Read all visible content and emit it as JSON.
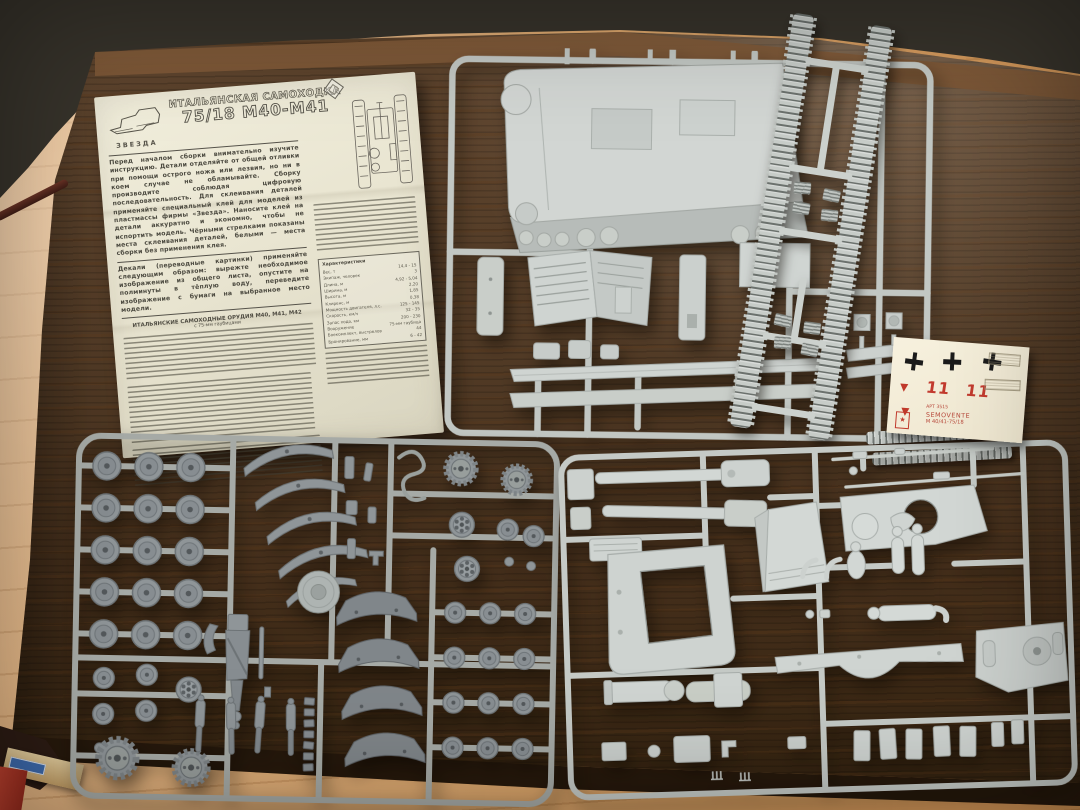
{
  "palette": {
    "table_wood": "#503a27",
    "curtain": "#37332b",
    "floor": "#dca96e",
    "paper": "#ece8d6",
    "sprue_light": "#c7ccc8",
    "sprue_dark": "#90969a",
    "decal_red": "#c0392b",
    "decal_black": "#1b1b1b"
  },
  "instruction_sheet": {
    "brand": "ЗВЕЗДА",
    "title_line1": "ИТАЛЬЯНСКАЯ САМОХОДКА",
    "title_line2": "75/18 М40-М41",
    "para_assembly": "Перед началом сборки внимательно изучите инструкцию. Детали отделяйте от общей отливки при помощи острого ножа или лезвия, но ни в коем случае не обламывайте. Сборку производите соблюдая цифровую последовательность. Для склеивания деталей применяйте специальный клей для моделей из пластмассы фирмы «Звезда». Наносите клей на детали аккуратно и экономно, чтобы не испортить модель. Чёрными стрелками показаны места склеивания деталей, белыми — места сборки без применения клея.",
    "para_decals": "Декали (переводные картинки) применяйте следующим образом: вырежте необходимое изображение из общего листа, опустите на полминуты в тёплую воду, переведите изображение с бумаги на выбранное место модели.",
    "history_header": "ИТАЛЬЯНСКИЕ САМОХОДНЫЕ ОРУДИЯ М40, М41, М42",
    "history_subheader": "с 75-мм гаубицами",
    "spec_table": {
      "header": "Характеристики",
      "rows": [
        {
          "label": "Вес, т",
          "value": "14,4 - 15"
        },
        {
          "label": "Экипаж, человек",
          "value": "3"
        },
        {
          "label": "Длина, м",
          "value": "4,92 - 5,04"
        },
        {
          "label": "Ширина, м",
          "value": "2,20"
        },
        {
          "label": "Высота, м",
          "value": "1,85"
        },
        {
          "label": "Клиренс, м",
          "value": "0,38"
        },
        {
          "label": "Мощность двигателя, л.с.",
          "value": "125 - 145"
        },
        {
          "label": "Скорость, км/ч",
          "value": "32 - 35"
        },
        {
          "label": "Запас хода, км",
          "value": "200 - 230"
        },
        {
          "label": "Вооружение",
          "value": "75-мм гаубица"
        },
        {
          "label": "Боекомплект, выстрелов",
          "value": "44"
        },
        {
          "label": "Бронирование, мм",
          "value": "6 - 42"
        }
      ]
    }
  },
  "decal_sheet": {
    "numbers": "11 11",
    "art_line": "АРТ 3515",
    "name_line": "SEMOVENTE",
    "model_line": "M 40/41-75/18",
    "logo_star": "★"
  }
}
